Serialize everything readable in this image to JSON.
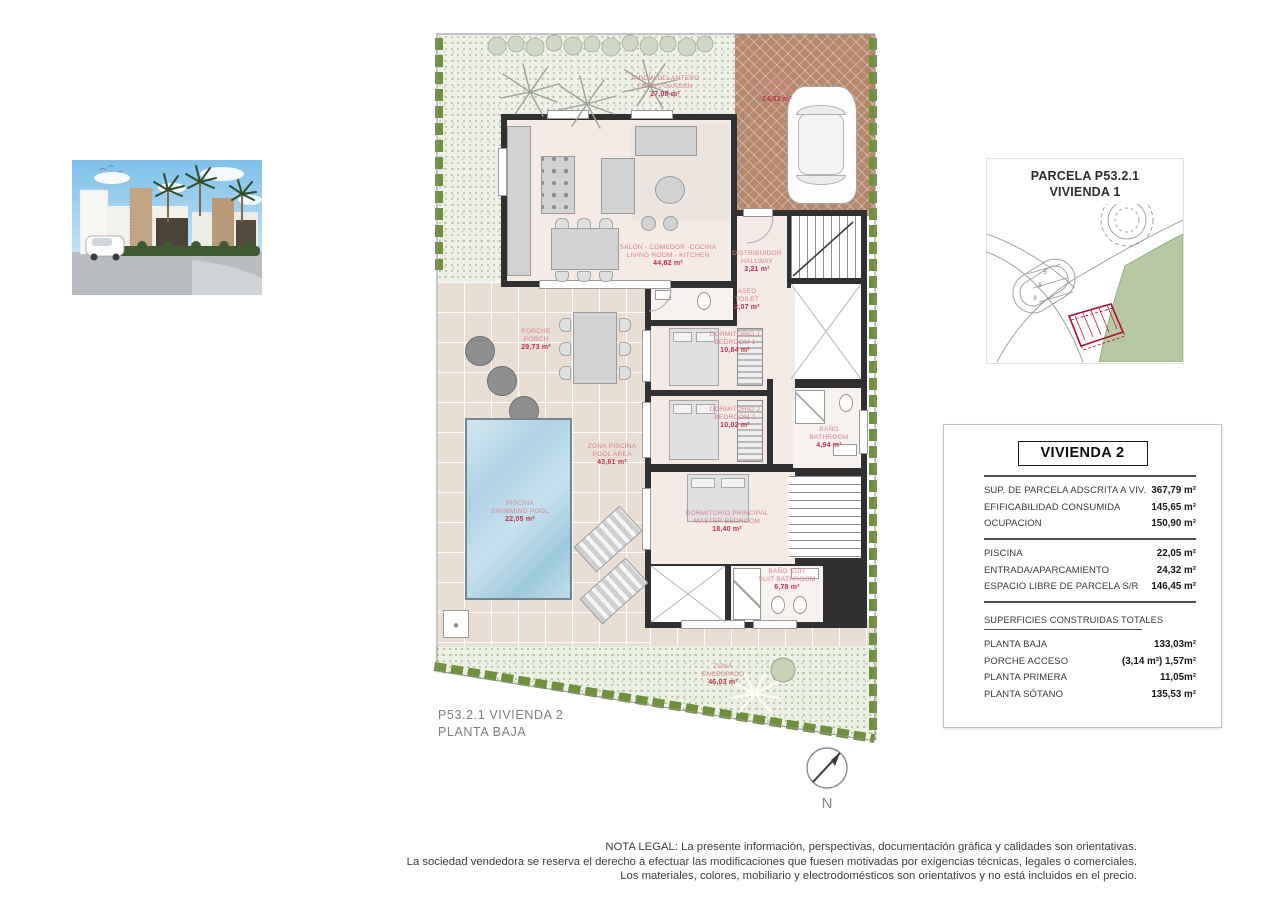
{
  "site_map": {
    "title_line1": "PARCELA P53.2.1",
    "title_line2": "VIVIENDA 1",
    "parcel_numbers": [
      "5",
      "6",
      "8"
    ]
  },
  "plan_caption": {
    "line1": "P53.2.1 VIVIENDA 2",
    "line2": "PLANTA BAJA"
  },
  "north_label": "N",
  "plan_labels": {
    "front_garden": {
      "es": "JARDÍN DELANTERO",
      "en": "FRONT GARDEN",
      "area": "27,08 m²"
    },
    "entrance": {
      "es": "ACCESO",
      "en": "ENTRANCE",
      "area": "24,32 m²"
    },
    "living": {
      "es": "SALÓN - COMEDOR -COCINA",
      "en": "LIVING ROOM - KITCHEN",
      "area": "44,82 m²"
    },
    "hallway": {
      "es": "DISTRIBUIDOR",
      "en": "HALLWAY",
      "area": "3,21 m²"
    },
    "toilet": {
      "es": "ASEO",
      "en": "TOILET",
      "area": "2,07 m²"
    },
    "bedroom1": {
      "es": "DORMITORIO 1",
      "en": "BEDROOM 1",
      "area": "10,84 m²"
    },
    "bedroom2": {
      "es": "DORMITORIO 2",
      "en": "BEDROOM 2",
      "area": "10,02 m²"
    },
    "bathroom": {
      "es": "BAÑO",
      "en": "BATHROOM",
      "area": "4,94 m²"
    },
    "master_bedroom": {
      "es": "DORMITORIO PRINCIPAL",
      "en": "MASTER BEDROOM",
      "area": "18,40 m²"
    },
    "suite_bathroom": {
      "es": "BAÑO SUIT",
      "en": "SUIT BATHROOM",
      "area": "6,78 m²"
    },
    "porch": {
      "es": "PORCHE",
      "en": "PORCH",
      "area": "29,73 m²"
    },
    "pool_area": {
      "es": "ZONA PISCINA",
      "en": "POOL AREA",
      "area": "43,61 m²"
    },
    "pool": {
      "es": "PISCINA",
      "en": "SWIMMING POOL",
      "area": "22,05 m²"
    },
    "lawn": {
      "es": "ZONA",
      "en": "ENCESPADO",
      "area": "46,03 m²"
    }
  },
  "info_panel": {
    "title": "VIVIENDA 2",
    "rows_top": [
      {
        "label": "SUP. DE PARCELA ADSCRITA A VIV.",
        "value": "367,79 m²"
      },
      {
        "label": "EFIFICABILIDAD CONSUMIDA",
        "value": "145,65 m²"
      },
      {
        "label": "OCUPACION",
        "value": "150,90 m²"
      }
    ],
    "rows_mid": [
      {
        "label": "PISCINA",
        "value": "22,05 m²"
      },
      {
        "label": "ENTRADA/APARCAMIENTO",
        "value": "24,32 m²"
      },
      {
        "label": "ESPACIO LIBRE DE PARCELA S/R",
        "value": "146,45 m²"
      }
    ],
    "section_heading": "SUPERFICIES CONSTRUIDAS TOTALES",
    "rows_bottom": [
      {
        "label": "PLANTA BAJA",
        "value": "133,03m²"
      },
      {
        "label": "PORCHE ACCESO",
        "value": "(3,14 m²) 1,57m²"
      },
      {
        "label": "PLANTA PRIMERA",
        "value": "11,05m²"
      },
      {
        "label": "PLANTA SÓTANO",
        "value": "135,53 m²"
      }
    ]
  },
  "legal": {
    "line1": "NOTA LEGAL: La presente información, perspectivas, documentación gráfica y calidades son orientativas.",
    "line2": "La sociedad vendedora se reserva el derecho a efectuar las modificaciones que fuesen motivadas por exigencias técnicas, legales o comerciales.",
    "line3": "Los materiales, colores, mobiliario y electrodomésticos son orientativos y no está incluidos en el precio."
  },
  "colors": {
    "label_pink": "#d9808f",
    "accent_red": "#c23049",
    "wall": "#313131",
    "hedge_green": "#6f913a",
    "pool_water": "#aed2e4",
    "driveway_brown": "#b5876b",
    "map_green": "#b7c9a2"
  }
}
